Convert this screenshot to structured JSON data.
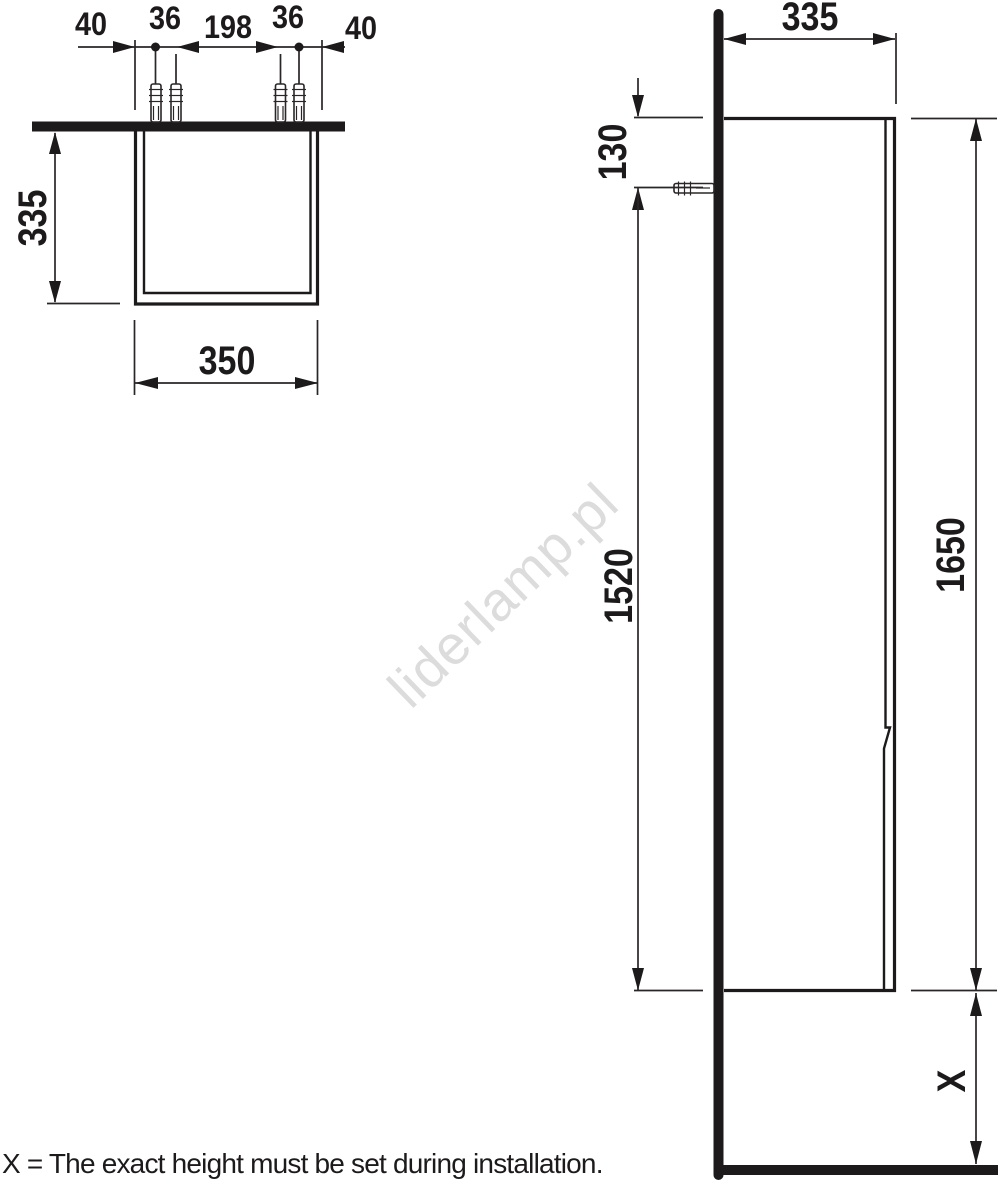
{
  "drawing": {
    "caption": "X = The exact height must be set during installation.",
    "watermark": "liderlamp.pl",
    "top_view": {
      "dim_wall_offset_left": "40",
      "dim_plug_pair_left": "36",
      "dim_plug_span": "198",
      "dim_plug_pair_right": "36",
      "dim_wall_offset_right": "40",
      "dim_depth": "335",
      "dim_width": "350"
    },
    "side_view": {
      "dim_depth": "335",
      "dim_top_to_anchor": "130",
      "dim_anchor_to_bottom": "1520",
      "dim_height": "1650",
      "dim_floor_clearance": "X"
    }
  },
  "colors": {
    "line": "#2a2627",
    "thick_line": "#1d1a1b",
    "text": "#1d1a1b",
    "watermark": "#dcdcdc",
    "background": "#ffffff"
  }
}
